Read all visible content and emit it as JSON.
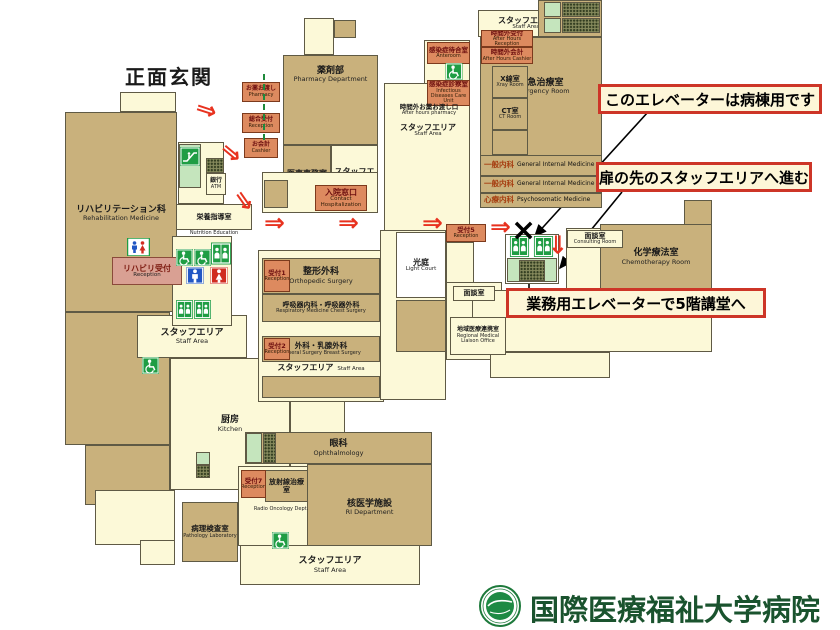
{
  "map": {
    "red_arrow_glyph": "⇒",
    "x_mark": {
      "x": 511,
      "y": 216,
      "glyph": "×"
    },
    "shapes": [
      {
        "n": "entrance-notch",
        "x": 120,
        "y": 92,
        "w": 56,
        "h": 20,
        "f": "cream"
      },
      {
        "n": "rehabilitation-dept",
        "x": 65,
        "y": 112,
        "w": 112,
        "h": 200,
        "f": "tan",
        "jp": "リハビリテーション科",
        "en": "Rehabilitation Medicine",
        "ly": 92,
        "fs": 9
      },
      {
        "n": "left-block-lower",
        "x": 65,
        "y": 312,
        "w": 105,
        "h": 133,
        "f": "tan"
      },
      {
        "n": "left-block-lower-2",
        "x": 85,
        "y": 445,
        "w": 85,
        "h": 60,
        "f": "tan"
      },
      {
        "n": "left-steps",
        "x": 95,
        "y": 490,
        "w": 80,
        "h": 55,
        "f": "cream"
      },
      {
        "n": "left-steps-2",
        "x": 140,
        "y": 540,
        "w": 35,
        "h": 25,
        "f": "cream"
      },
      {
        "n": "staff-area-left",
        "x": 137,
        "y": 315,
        "w": 110,
        "h": 43,
        "f": "cream",
        "jp": "スタッフエリア",
        "en": "Staff Area",
        "fs": 9
      },
      {
        "n": "kitchen",
        "x": 170,
        "y": 358,
        "w": 120,
        "h": 132,
        "f": "cream",
        "jp": "厨房",
        "en": "Kitchen",
        "fs": 9
      },
      {
        "n": "kitchen-extension",
        "x": 290,
        "y": 358,
        "w": 55,
        "h": 130,
        "f": "cream"
      },
      {
        "n": "escalator-panel",
        "x": 178,
        "y": 142,
        "w": 46,
        "h": 62,
        "f": "cream"
      },
      {
        "n": "nutrition-education-room",
        "x": 176,
        "y": 204,
        "w": 76,
        "h": 26,
        "f": "cream",
        "jp": "栄養指導室",
        "fs": 7
      },
      {
        "n": "icon-panel",
        "x": 172,
        "y": 236,
        "w": 60,
        "h": 90,
        "f": "cream"
      },
      {
        "n": "pharmacy-strip",
        "x": 304,
        "y": 18,
        "w": 30,
        "h": 37,
        "f": "cream"
      },
      {
        "n": "pharmacy-cell",
        "x": 334,
        "y": 20,
        "w": 22,
        "h": 18,
        "f": "tan"
      },
      {
        "n": "pharmacy-department",
        "x": 283,
        "y": 55,
        "w": 95,
        "h": 90,
        "f": "tan",
        "jp": "薬剤部",
        "en": "Pharmacy Department",
        "ly": 10,
        "fs": 9
      },
      {
        "n": "administration-office",
        "x": 283,
        "y": 145,
        "w": 48,
        "h": 68,
        "f": "tan",
        "jp": "医事事務室",
        "en": "Administration Office",
        "fs": 8
      },
      {
        "n": "staff-area-mid",
        "x": 331,
        "y": 145,
        "w": 47,
        "h": 68,
        "f": "cream",
        "jp": "スタッフエリア",
        "en": "Staff Area",
        "fs": 8
      },
      {
        "n": "admin-under-panel",
        "x": 262,
        "y": 172,
        "w": 116,
        "h": 41,
        "f": "cream"
      },
      {
        "n": "admin-under-cell",
        "x": 264,
        "y": 180,
        "w": 24,
        "h": 28,
        "f": "tan"
      },
      {
        "n": "infection-panel",
        "x": 384,
        "y": 83,
        "w": 86,
        "h": 148,
        "f": "cream"
      },
      {
        "n": "anteroom-panel",
        "x": 424,
        "y": 40,
        "w": 46,
        "h": 44,
        "f": "cream"
      },
      {
        "n": "clinic-panel",
        "x": 258,
        "y": 250,
        "w": 126,
        "h": 152,
        "f": "cream"
      },
      {
        "n": "orthopedic-surgery",
        "x": 262,
        "y": 258,
        "w": 118,
        "h": 36,
        "f": "tan",
        "jp": "整形外科",
        "en": "Orthopedic Surgery",
        "fs": 9
      },
      {
        "n": "respiratory-chest-surgery",
        "x": 262,
        "y": 294,
        "w": 118,
        "h": 28,
        "f": "tan",
        "jp": "呼吸器内科・呼吸器外科",
        "en": "Respiratory Medicine Chest Surgery",
        "fs": 7
      },
      {
        "n": "general-breast-surgery",
        "x": 262,
        "y": 336,
        "w": 118,
        "h": 26,
        "f": "tan",
        "jp": "外科・乳腺外科",
        "en": "General Surgery Breast Surgery",
        "fs": 7.5
      },
      {
        "n": "clinic-cells-row",
        "x": 262,
        "y": 376,
        "w": 118,
        "h": 22,
        "f": "tan"
      },
      {
        "n": "court-panel",
        "x": 380,
        "y": 230,
        "w": 66,
        "h": 170,
        "f": "cream"
      },
      {
        "n": "light-court",
        "x": 396,
        "y": 232,
        "w": 50,
        "h": 66,
        "f": "white",
        "jp": "光庭",
        "en": "Light Court",
        "fs": 8
      },
      {
        "n": "court-cell",
        "x": 396,
        "y": 300,
        "w": 50,
        "h": 52,
        "f": "tan"
      },
      {
        "n": "ophthalmology",
        "x": 245,
        "y": 432,
        "w": 187,
        "h": 32,
        "f": "tan",
        "jp": "眼科",
        "en": "Ophthalmology",
        "fs": 9
      },
      {
        "n": "radio-panel",
        "x": 238,
        "y": 466,
        "w": 70,
        "h": 80,
        "f": "cream"
      },
      {
        "n": "ri-department",
        "x": 307,
        "y": 464,
        "w": 125,
        "h": 82,
        "f": "tan",
        "jp": "核医学施設",
        "en": "RI Department",
        "ly": 34,
        "fs": 9
      },
      {
        "n": "radio-oncology",
        "x": 265,
        "y": 470,
        "w": 43,
        "h": 32,
        "f": "tan",
        "jp": "放射線治療室",
        "fs": 7
      },
      {
        "n": "pathology-laboratory",
        "x": 182,
        "y": 502,
        "w": 56,
        "h": 60,
        "f": "tan",
        "jp": "病理検査室",
        "en": "Pathology Laboratory",
        "fs": 7.5
      },
      {
        "n": "staff-area-bottom",
        "x": 240,
        "y": 545,
        "w": 180,
        "h": 40,
        "f": "cream",
        "jp": "スタッフエリア",
        "en": "Staff Area",
        "fs": 9
      },
      {
        "n": "staff-area-top",
        "x": 478,
        "y": 10,
        "w": 96,
        "h": 27,
        "f": "cream",
        "jp": "スタッフエリア",
        "en": "Staff Area",
        "fs": 8
      },
      {
        "n": "top-cells-block",
        "x": 538,
        "y": 0,
        "w": 64,
        "h": 37,
        "f": "tan"
      },
      {
        "n": "emergency-room",
        "x": 480,
        "y": 37,
        "w": 122,
        "h": 171,
        "f": "tan",
        "jp": "救急治療室",
        "en": "Emergency Room",
        "ly": 40,
        "fs": 9
      },
      {
        "n": "xray-room",
        "x": 492,
        "y": 66,
        "w": 36,
        "h": 32,
        "f": "tan",
        "jp": "X線室",
        "en": "Xray Room",
        "fs": 7
      },
      {
        "n": "ct-room",
        "x": 492,
        "y": 98,
        "w": 36,
        "h": 32,
        "f": "tan",
        "jp": "CT室",
        "en": "CT Room",
        "fs": 7
      },
      {
        "n": "cell-below-ct",
        "x": 492,
        "y": 130,
        "w": 36,
        "h": 25,
        "f": "tan"
      },
      {
        "n": "reception5-column",
        "x": 446,
        "y": 242,
        "w": 28,
        "h": 90,
        "f": "cream"
      },
      {
        "n": "bottom-left-cream",
        "x": 446,
        "y": 282,
        "w": 56,
        "h": 78,
        "f": "cream"
      },
      {
        "n": "consult-panel",
        "x": 566,
        "y": 228,
        "w": 58,
        "h": 64,
        "f": "cream"
      },
      {
        "n": "chemo-side-block",
        "x": 684,
        "y": 200,
        "w": 28,
        "h": 26,
        "f": "tan"
      },
      {
        "n": "chemotherapy-room",
        "x": 600,
        "y": 224,
        "w": 112,
        "h": 66,
        "f": "tan",
        "jp": "化学療法室",
        "en": "Chemotherapy Room",
        "fs": 9
      },
      {
        "n": "bottom-right-cream-1",
        "x": 472,
        "y": 290,
        "w": 240,
        "h": 62,
        "f": "cream"
      },
      {
        "n": "bottom-right-cream-2",
        "x": 490,
        "y": 352,
        "w": 120,
        "h": 26,
        "f": "cream"
      },
      {
        "n": "elevator-bank",
        "x": 505,
        "y": 234,
        "w": 54,
        "h": 50,
        "f": "white"
      },
      {
        "n": "elevator-bank-lower",
        "x": 507,
        "y": 258,
        "w": 50,
        "h": 24,
        "f": "green"
      }
    ],
    "cells": [
      {
        "x": 544,
        "y": 2,
        "w": 17,
        "h": 15,
        "f": "green"
      },
      {
        "x": 562,
        "y": 2,
        "w": 38,
        "h": 15,
        "f": "dots"
      },
      {
        "x": 544,
        "y": 18,
        "w": 17,
        "h": 15,
        "f": "green"
      },
      {
        "x": 562,
        "y": 18,
        "w": 38,
        "h": 15,
        "f": "dots"
      },
      {
        "x": 246,
        "y": 433,
        "w": 16,
        "h": 30,
        "f": "green"
      },
      {
        "x": 263,
        "y": 433,
        "w": 13,
        "h": 30,
        "f": "dots"
      },
      {
        "x": 206,
        "y": 158,
        "w": 18,
        "h": 15,
        "f": "dots"
      },
      {
        "x": 179,
        "y": 144,
        "w": 22,
        "h": 44,
        "f": "green"
      },
      {
        "x": 196,
        "y": 452,
        "w": 14,
        "h": 13,
        "f": "green"
      },
      {
        "x": 196,
        "y": 465,
        "w": 14,
        "h": 13,
        "f": "dots"
      },
      {
        "x": 519,
        "y": 260,
        "w": 26,
        "h": 21,
        "f": "dots"
      }
    ],
    "strips": [
      {
        "n": "general-internal-medicine-1",
        "x": 480,
        "y": 155,
        "w": 122,
        "h": 21,
        "jp": "一般内科",
        "en": "General Internal Medicine"
      },
      {
        "n": "general-internal-medicine-2",
        "x": 480,
        "y": 176,
        "w": 122,
        "h": 17,
        "jp": "一般内科",
        "en": "General Internal Medicine"
      },
      {
        "n": "psychosomatic-medicine",
        "x": 480,
        "y": 193,
        "w": 122,
        "h": 15,
        "jp": "心療内科",
        "en": "Psychosomatic Medicine"
      }
    ],
    "labels": [
      {
        "n": "main-entrance-label",
        "s": "e",
        "x": 104,
        "y": 62,
        "w": 130,
        "h": 30,
        "jp": "正面玄関",
        "fs": 20
      },
      {
        "n": "pharmacy-counter-label",
        "s": "o",
        "x": 242,
        "y": 82,
        "w": 38,
        "h": 20,
        "jp": "お薬お渡し",
        "en": "Pharmacy",
        "fs": 6
      },
      {
        "n": "general-reception-label",
        "s": "o",
        "x": 242,
        "y": 113,
        "w": 38,
        "h": 20,
        "jp": "総合受付",
        "en": "Reception",
        "fs": 6
      },
      {
        "n": "cashier-label",
        "s": "o",
        "x": 244,
        "y": 138,
        "w": 34,
        "h": 20,
        "jp": "お会計",
        "en": "Cashier",
        "fs": 6
      },
      {
        "n": "hospitalization-window-label",
        "s": "o",
        "x": 315,
        "y": 185,
        "w": 52,
        "h": 26,
        "jp": "入院窓口",
        "en": "Contact Hospitalization",
        "fs": 8
      },
      {
        "n": "reception1-label",
        "s": "o",
        "x": 264,
        "y": 260,
        "w": 26,
        "h": 32,
        "jp": "受付1",
        "en": "Reception",
        "fs": 6.5
      },
      {
        "n": "reception2-label",
        "s": "o",
        "x": 264,
        "y": 338,
        "w": 26,
        "h": 22,
        "jp": "受付2",
        "en": "Reception",
        "fs": 6.5
      },
      {
        "n": "reception5-label",
        "s": "o",
        "x": 446,
        "y": 224,
        "w": 40,
        "h": 18,
        "jp": "受付5",
        "en": "Reception",
        "fs": 6.5
      },
      {
        "n": "reception7-label",
        "s": "o",
        "x": 241,
        "y": 470,
        "w": 25,
        "h": 28,
        "jp": "受付7",
        "en": "Reception",
        "fs": 6.5
      },
      {
        "n": "after-hours-reception-label",
        "s": "o",
        "x": 481,
        "y": 30,
        "w": 52,
        "h": 17,
        "jp": "時間外受付",
        "en": "After Hours Reception",
        "fs": 6.5
      },
      {
        "n": "after-hours-cashier-label",
        "s": "o",
        "x": 481,
        "y": 47,
        "w": 52,
        "h": 17,
        "jp": "時間外会計",
        "en": "After Hours Cashier",
        "fs": 6.5
      },
      {
        "n": "anteroom-label",
        "s": "o",
        "x": 427,
        "y": 42,
        "w": 43,
        "h": 22,
        "jp": "感染症待合室",
        "en": "Anteroom",
        "fs": 6.5
      },
      {
        "n": "infectious-diseases-label",
        "s": "o",
        "x": 427,
        "y": 80,
        "w": 43,
        "h": 26,
        "jp": "感染症診察室",
        "en": "Infectious Diseases Care Unit",
        "fs": 6.5
      },
      {
        "n": "rehab-reception-label",
        "s": "p",
        "x": 112,
        "y": 257,
        "w": 70,
        "h": 28,
        "jp": "リハビリ受付",
        "en": "Reception",
        "fs": 8
      },
      {
        "n": "after-hours-pharmacy-label",
        "s": "t",
        "x": 386,
        "y": 101,
        "w": 86,
        "h": 18,
        "jp": "時間外お薬お渡し口",
        "en": "After hours pharmacy",
        "fs": 6.5
      },
      {
        "n": "staff-area-infection-label",
        "s": "t",
        "x": 390,
        "y": 121,
        "w": 76,
        "h": 18,
        "jp": "スタッフエリア",
        "en": "Staff Area",
        "fs": 8
      },
      {
        "n": "nutrition-education-en-label",
        "s": "t",
        "x": 176,
        "y": 229,
        "w": 76,
        "h": 10,
        "en": "Nutrition Education",
        "fs": 7.5
      },
      {
        "n": "staff-area-clinic-label",
        "s": "t",
        "x": 262,
        "y": 361,
        "w": 118,
        "h": 14,
        "jp": "スタッフエリア",
        "en": "Staff Area",
        "fs": 8,
        "inline": true
      },
      {
        "n": "radio-oncology-en-label",
        "s": "t",
        "x": 250,
        "y": 502,
        "w": 62,
        "h": 16,
        "en": "Radio Oncology Dept.",
        "fs": 7.5
      },
      {
        "n": "consulting-room-1-label",
        "s": "b",
        "x": 567,
        "y": 230,
        "w": 56,
        "h": 18,
        "jp": "面談室",
        "en": "Consulting Room",
        "fs": 7
      },
      {
        "n": "consulting-room-2-label",
        "s": "b",
        "x": 453,
        "y": 286,
        "w": 42,
        "h": 15,
        "jp": "面談室",
        "fs": 7
      },
      {
        "n": "liaison-office-label",
        "s": "b",
        "x": 450,
        "y": 317,
        "w": 56,
        "h": 38,
        "jp": "地域医療連携室",
        "en": "Regional Medical Liaison Office",
        "fs": 6
      },
      {
        "n": "bank-atm-label",
        "s": "b",
        "x": 206,
        "y": 173,
        "w": 20,
        "h": 22,
        "jp": "銀行",
        "en": "ATM",
        "fs": 6
      }
    ],
    "icons": [
      {
        "t": "toilet",
        "x": 127,
        "y": 238,
        "w": 23,
        "h": 18
      },
      {
        "t": "wheelchair",
        "x": 176,
        "y": 249,
        "w": 17,
        "h": 17
      },
      {
        "t": "wheelchair",
        "x": 194,
        "y": 249,
        "w": 17,
        "h": 17
      },
      {
        "t": "elevator",
        "x": 211,
        "y": 241,
        "w": 20,
        "h": 25
      },
      {
        "t": "men",
        "x": 186,
        "y": 267,
        "w": 18,
        "h": 17
      },
      {
        "t": "women",
        "x": 210,
        "y": 267,
        "w": 18,
        "h": 17
      },
      {
        "t": "elevator",
        "x": 176,
        "y": 298,
        "w": 17,
        "h": 23
      },
      {
        "t": "elevator",
        "x": 194,
        "y": 298,
        "w": 17,
        "h": 23
      },
      {
        "t": "escalator",
        "x": 180,
        "y": 147,
        "w": 20,
        "h": 19
      },
      {
        "t": "wheelchair",
        "x": 142,
        "y": 357,
        "w": 17,
        "h": 17
      },
      {
        "t": "wheelchair",
        "x": 272,
        "y": 532,
        "w": 17,
        "h": 17
      },
      {
        "t": "wheelchair",
        "x": 444,
        "y": 63,
        "w": 20,
        "h": 17
      },
      {
        "t": "elevator",
        "x": 508,
        "y": 236,
        "w": 23,
        "h": 21
      },
      {
        "t": "elevator",
        "x": 532,
        "y": 236,
        "w": 23,
        "h": 21
      }
    ],
    "red_arrows": [
      {
        "x": 196,
        "y": 97,
        "r": 18
      },
      {
        "x": 221,
        "y": 140,
        "r": 40
      },
      {
        "x": 234,
        "y": 188,
        "r": 55
      },
      {
        "x": 264,
        "y": 210,
        "r": 0
      },
      {
        "x": 338,
        "y": 210,
        "r": 0
      },
      {
        "x": 422,
        "y": 210,
        "r": 0
      },
      {
        "x": 490,
        "y": 214,
        "r": 0
      },
      {
        "x": 548,
        "y": 232,
        "r": 90
      }
    ],
    "black_arrows": [
      {
        "x1": 648,
        "y1": 112,
        "x2": 535,
        "y2": 236
      },
      {
        "x1": 622,
        "y1": 192,
        "x2": 560,
        "y2": 268
      },
      {
        "x1": 529,
        "y1": 294,
        "x2": 529,
        "y2": 266
      }
    ],
    "green_line": {
      "x": 263,
      "y": 74,
      "h": 66
    },
    "callouts": [
      {
        "n": "callout-ward-elevator",
        "x": 598,
        "y": 84,
        "w": 224,
        "h": 30,
        "text": "このエレベーターは病棟用です"
      },
      {
        "n": "callout-staff-door",
        "x": 596,
        "y": 162,
        "w": 216,
        "h": 30,
        "text": "扉の先のスタッフエリアへ進む"
      },
      {
        "n": "callout-service-elevator",
        "x": 506,
        "y": 288,
        "w": 260,
        "h": 30,
        "text": "業務用エレベーターで5階講堂へ"
      }
    ]
  },
  "footer": {
    "name": "国際医療福祉大学病院"
  }
}
